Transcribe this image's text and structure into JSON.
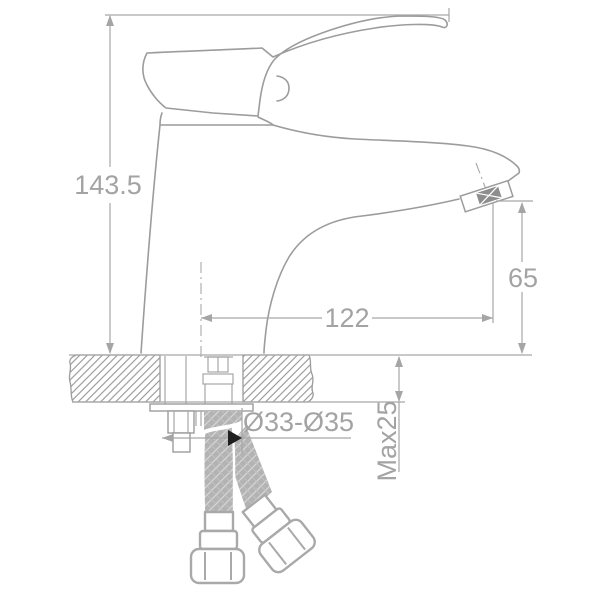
{
  "drawing": {
    "labels": {
      "overall_height": "143.5",
      "spout_reach": "122",
      "outlet_height": "65",
      "mounting_hole_diameter": "Ø33-Ø35",
      "max_deck_thickness": "Max25"
    },
    "colors": {
      "background": "#ffffff",
      "line_gray": "#9c9c9c",
      "dimension_gray": "#a6a6a6",
      "text_gray": "#a3a3a3",
      "braid_gray": "#b3b3b3",
      "aerator_dark_gray": "#8d8d8d",
      "leader_arrow_black": "#1f1f1f"
    }
  }
}
